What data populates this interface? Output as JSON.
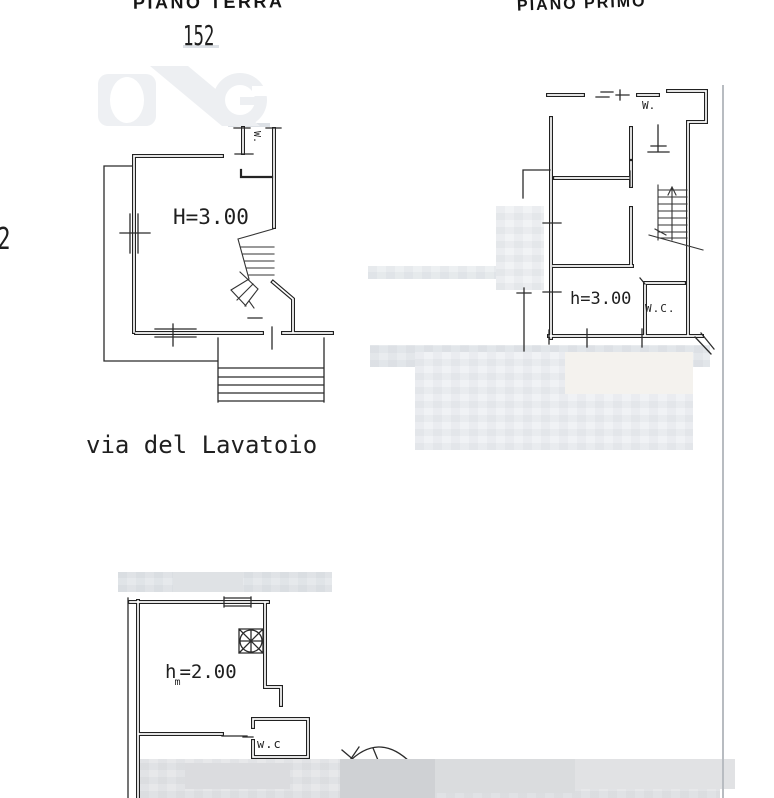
{
  "colors": {
    "ink": "#1f1f1f",
    "paper": "#ffffff",
    "redaction_gray": "#e7e8ea",
    "scan_line_gray": "#b8bcc1",
    "watermark_gray": "#edeff2"
  },
  "header": {
    "title_left": "PIANO TERRA",
    "title_right": "PIANO PRIMO",
    "sheet_number": "152"
  },
  "margin": {
    "page_number": "2"
  },
  "street_label": "via del Lavatoio",
  "ground_floor": {
    "height_label": "H=3.00",
    "closet_label": "W."
  },
  "first_floor": {
    "height_label": "h=3.00",
    "closet_label": "W.",
    "wc_label": "W.C."
  },
  "bottom_plan": {
    "height_main": "h",
    "height_subscript": "m",
    "height_rest": "=2.00",
    "wc_label": "w.c"
  }
}
